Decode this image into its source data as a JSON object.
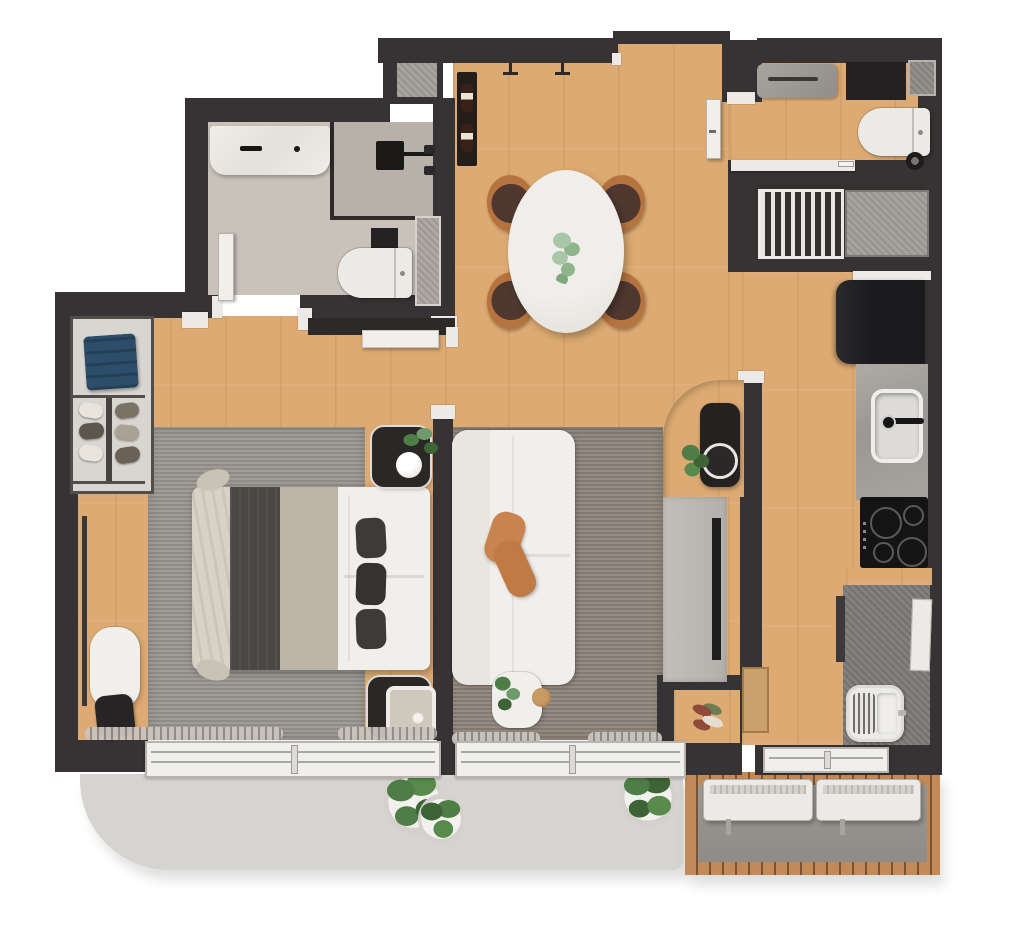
{
  "meta": {
    "kind": "3d-rendered-floor-plan",
    "view": "top-down",
    "canvas": "1024x931",
    "visible_text": []
  },
  "palette": {
    "wall": "#373334",
    "wall_dark": "#2d2a2b",
    "wood": "#dcaa72",
    "bath_floor": "#c9c2bb",
    "shower_floor": "#b8b1aa",
    "marble": "#edebe7",
    "backsplash": "#dcd8d3",
    "rug_bedroom": "#97938e",
    "rug_living": "#8b8177",
    "balcony": "#d6d4d1",
    "deck_wood": "#c28a58",
    "deck_gap": "#7a5432",
    "deck_floor": "#8f8c88",
    "counter": "#a3a09c",
    "concrete": "#7c7a76",
    "appliance": "#1b1a1c",
    "white_furniture": "#f1efeb",
    "soft_white": "#eceae6",
    "cushion_tan": "#c9834e",
    "clothes_blue": "#2c4e6a",
    "blanket_dark": "#4a4744",
    "blanket_mid": "#bdb4a8",
    "throw_beige": "#d8d1c5",
    "plant_dark": "#3c6436",
    "plant_mid": "#4e7d46",
    "plant_light": "#a9c6a6",
    "chair_wood": "#b5743f",
    "chair_seat": "#503830",
    "window_frame": "#f0efec"
  },
  "rooms": [
    {
      "id": "bathroom",
      "features": [
        "vanity-sink",
        "marble-counter",
        "glass-shower",
        "shower-head",
        "toilet",
        "wall-niche"
      ]
    },
    {
      "id": "entry-hall",
      "features": [
        "front-door",
        "coat-hooks",
        "wine-rack"
      ]
    },
    {
      "id": "dining-area",
      "features": [
        "oval-table",
        "four-wood-chairs",
        "plant-centerpiece"
      ]
    },
    {
      "id": "wc-laundry",
      "features": [
        "washer-counter",
        "black-cabinet",
        "toilet",
        "waste-bin",
        "shaft-niche"
      ]
    },
    {
      "id": "technical-shafts",
      "features": [
        "drying-rack-grille",
        "concrete-shaft"
      ]
    },
    {
      "id": "kitchen",
      "features": [
        "refrigerator",
        "stone-counter",
        "steel-sink",
        "faucet",
        "four-burner-cooktop",
        "laundry-tub",
        "ironing-board"
      ]
    },
    {
      "id": "living-room",
      "features": [
        "white-modular-sofa",
        "tan-cushions",
        "area-rug",
        "side-table",
        "tv-panel",
        "curved-wood-nook",
        "black-armchair",
        "round-table",
        "flower-niche"
      ]
    },
    {
      "id": "bedroom",
      "features": [
        "double-bed",
        "dark-accent-pillows",
        "area-rug",
        "two-nightstands",
        "table-lamp",
        "open-wardrobe",
        "blue-folded-clothes",
        "shoe-shelves",
        "floor-mirror",
        "bench",
        "bag",
        "sliding-door"
      ]
    },
    {
      "id": "balcony-terrace",
      "features": [
        "curved-slab",
        "three-potted-plants",
        "sliding-windows",
        "curtains"
      ]
    },
    {
      "id": "service-deck",
      "features": [
        "wood-slat-border",
        "two-ac-condenser-units",
        "service-window"
      ]
    }
  ]
}
